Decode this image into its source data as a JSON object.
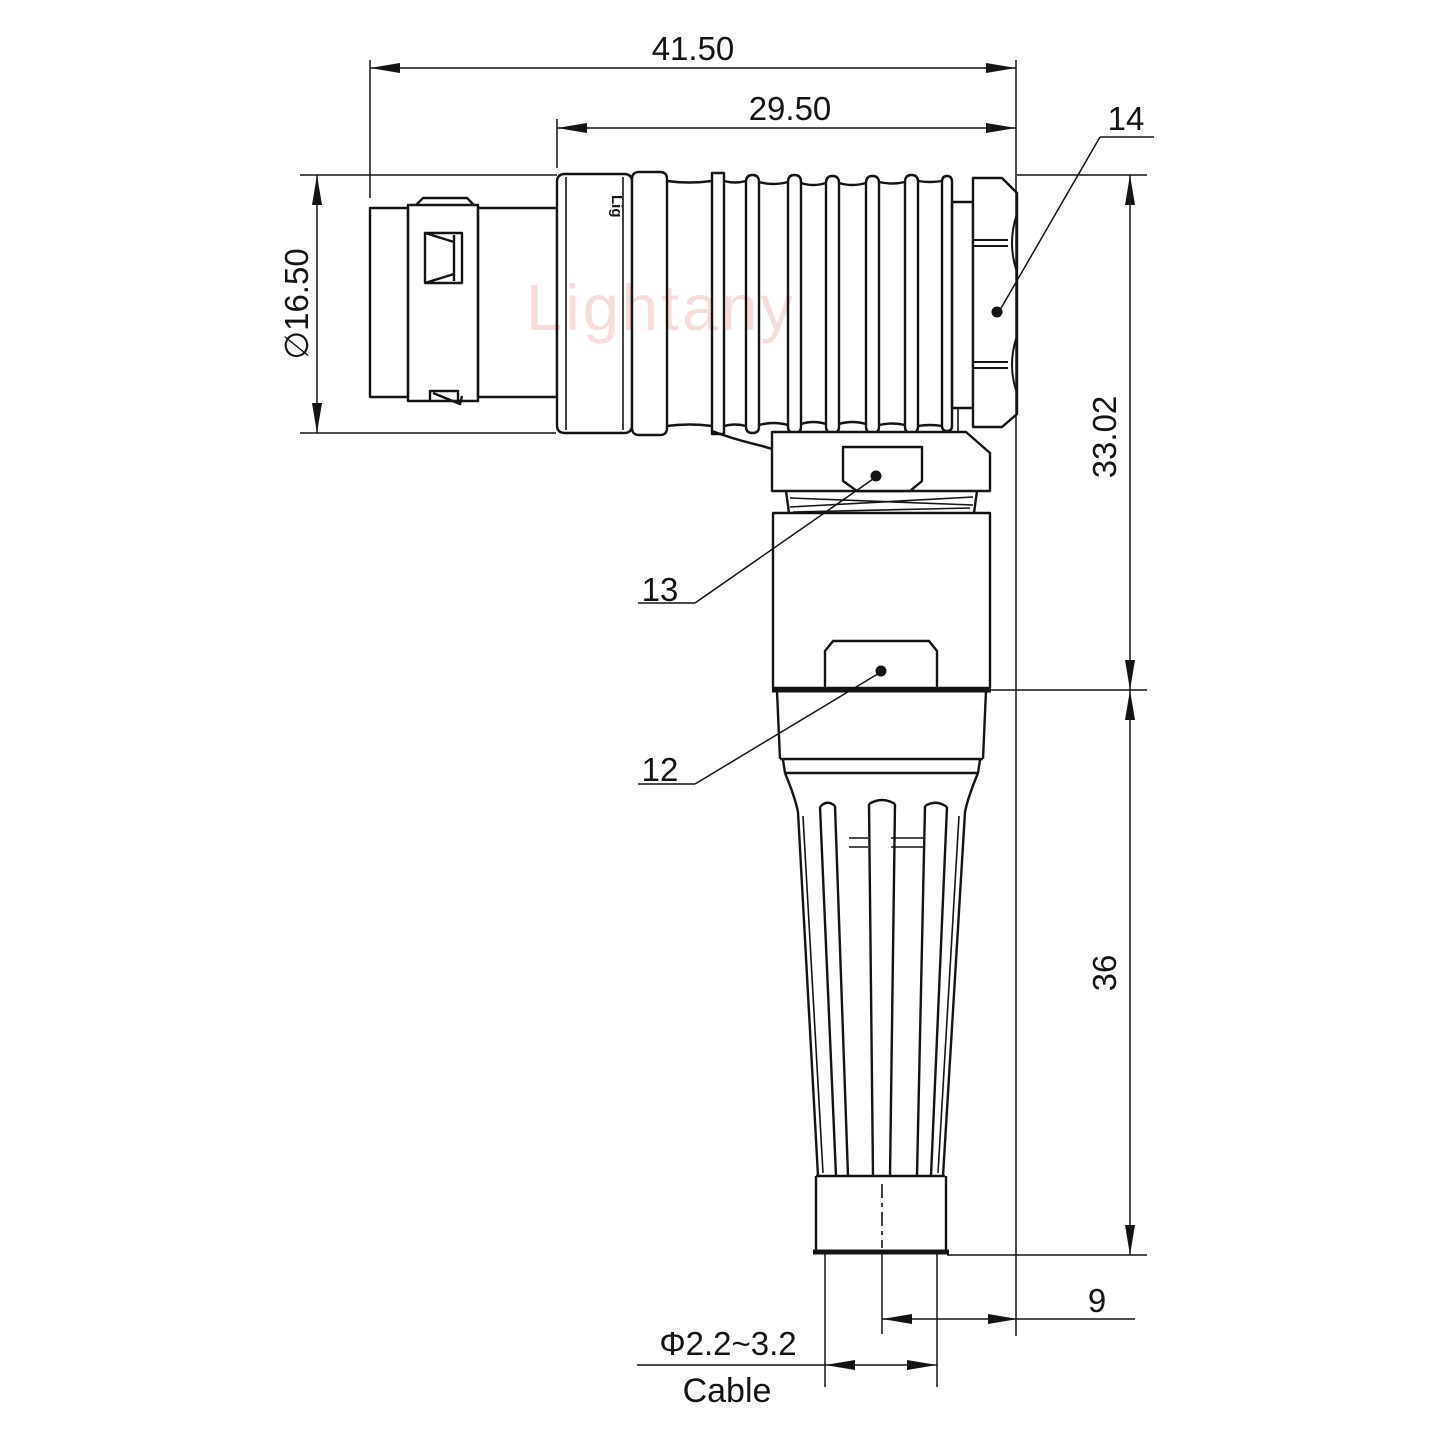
{
  "drawing": {
    "dimensions": {
      "overall_length": "41.50",
      "body_length": "29.50",
      "plug_diameter": "∅16.50",
      "elbow_height": "33.02",
      "boot_height": "36",
      "tail_length": "9",
      "cable_diameter": "Φ2.2~3.2",
      "cable_label": "Cable"
    },
    "callouts": {
      "nut": "14",
      "collar": "13",
      "body": "12"
    },
    "watermark": {
      "brand": "Lightany",
      "marking": "Lig"
    },
    "colors": {
      "line": "#141414",
      "watermark": "#f0b9b9",
      "background": "#ffffff"
    }
  }
}
